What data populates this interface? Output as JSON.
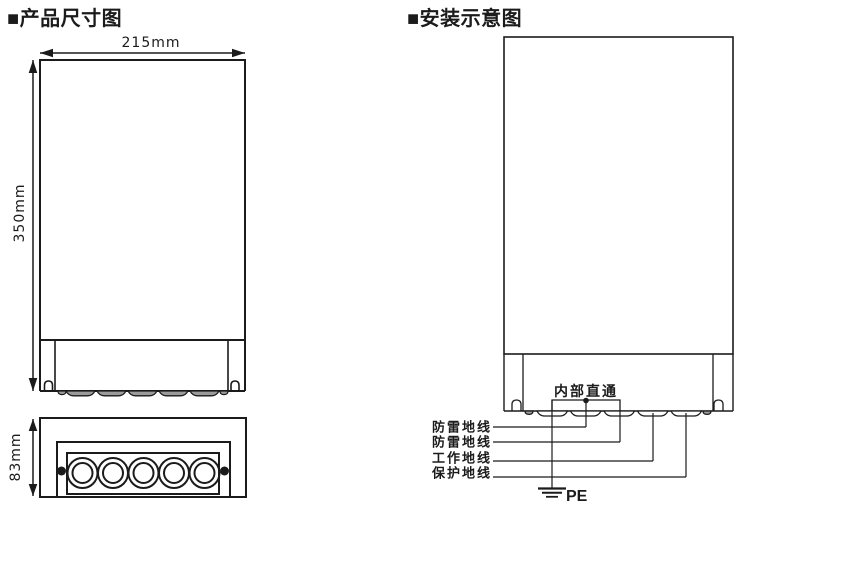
{
  "left_panel": {
    "title": "■产品尺寸图",
    "width_label": "215mm",
    "height_label": "350mm",
    "depth_label": "83mm"
  },
  "right_panel": {
    "title": "■安装示意图",
    "bracket_label": "内部直通",
    "wire_labels": [
      "防雷地线",
      "防雷地线",
      "工作地线",
      "保护地线"
    ],
    "ground_label": "PE"
  },
  "colors": {
    "line": "#1b1b1b",
    "scallop_fill": "#9b9b9b",
    "background": "#ffffff"
  }
}
